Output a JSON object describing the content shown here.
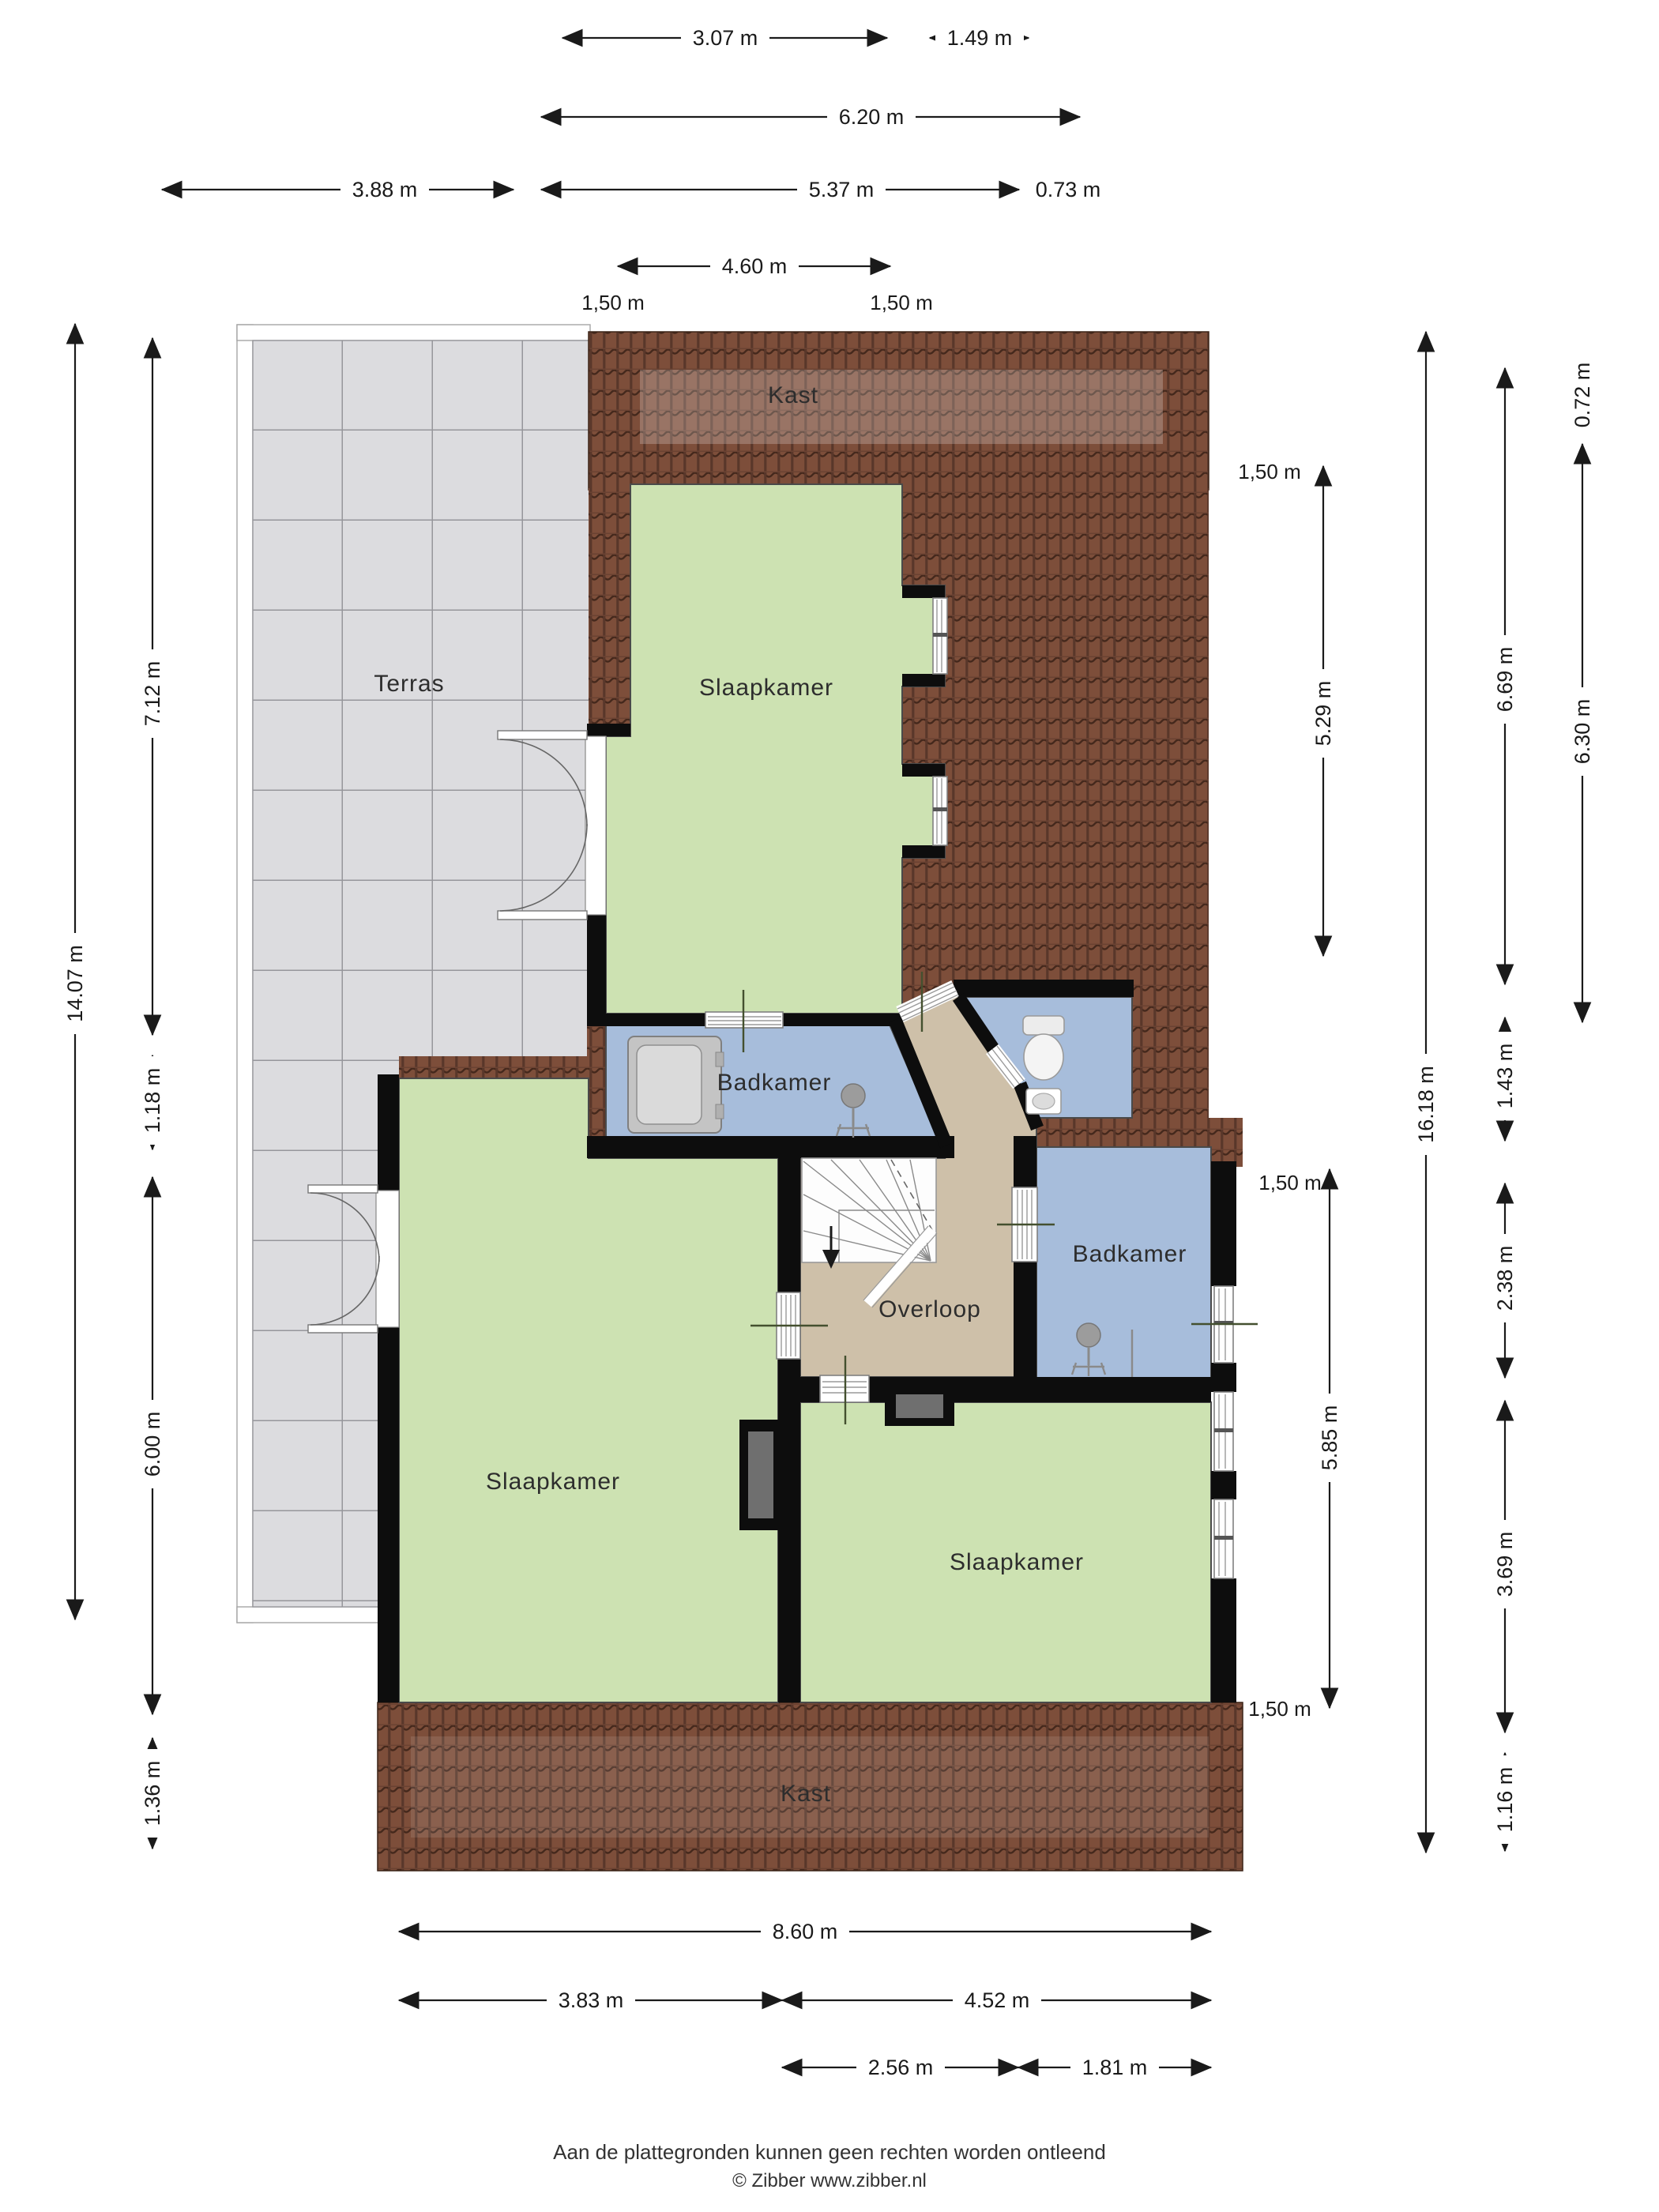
{
  "plan": {
    "rooms": {
      "kast_top": "Kast",
      "slaapkamer_top": "Slaapkamer",
      "terras": "Terras",
      "badkamer_left": "Badkamer",
      "overloop": "Overloop",
      "badkamer_right": "Badkamer",
      "slaapkamer_left": "Slaapkamer",
      "slaapkamer_right": "Slaapkamer",
      "kast_bottom": "Kast"
    },
    "dims": {
      "top": [
        "3.07 m",
        "1.49 m",
        "6.20 m",
        "3.88 m",
        "5.37 m",
        "0.73 m",
        "4.60 m",
        "1,50 m",
        "1,50 m"
      ],
      "left": [
        "14.07 m",
        "7.12 m",
        "1.18 m",
        "6.00 m",
        "1.36 m"
      ],
      "right": [
        "1,50 m",
        "5.29 m",
        "1,50 m",
        "5.85 m",
        "1,50 m",
        "16.18 m",
        "0.72 m",
        "6.69 m",
        "6.30 m",
        "1.43 m",
        "2.38 m",
        "3.69 m",
        "1.16 m"
      ],
      "bottom": [
        "8.60 m",
        "3.83 m",
        "4.52 m",
        "2.56 m",
        "1.81 m"
      ]
    },
    "colors": {
      "roof": "#7d4e3a",
      "roof_dark": "#44281c",
      "room_green": "#cde2b2",
      "bathroom_blue": "#a7bddb",
      "hall_tan": "#cec0a9",
      "terrace_gray": "#dcdcdf",
      "wall": "#0d0d0d"
    }
  },
  "footer": {
    "disclaimer": "Aan de plattegronden kunnen geen rechten worden ontleend",
    "credit": "© Zibber www.zibber.nl"
  }
}
